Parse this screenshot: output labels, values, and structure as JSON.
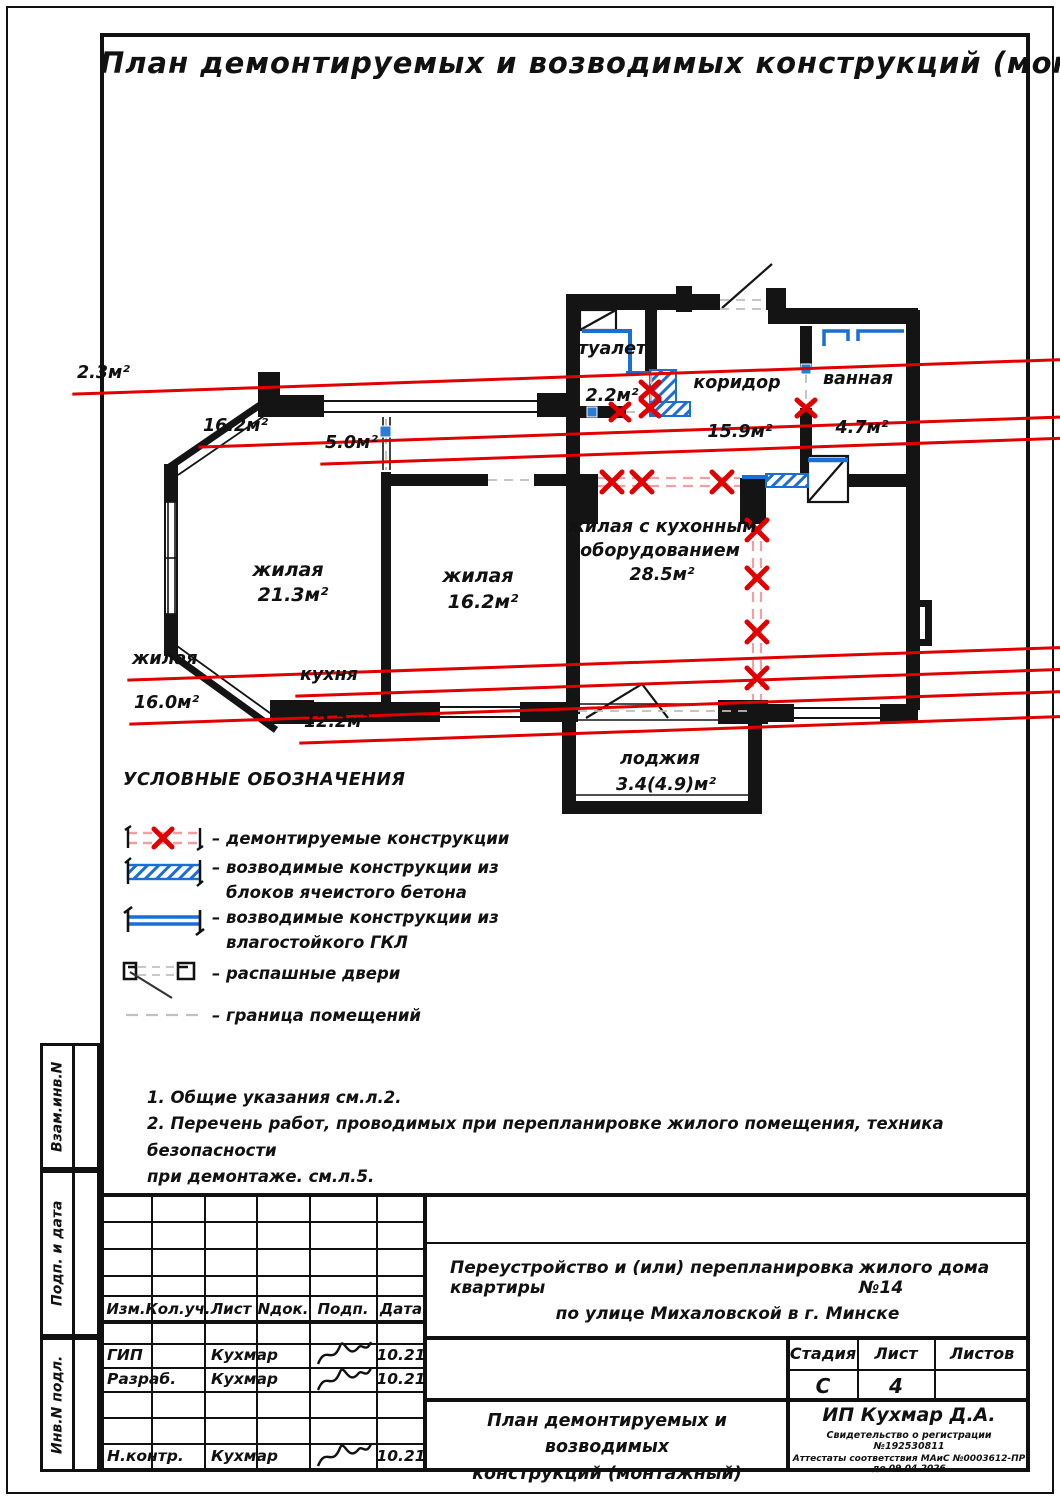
{
  "page_title": "План демонтируемых и возводимых конструкций (монтажный)",
  "plan": {
    "rooms": {
      "zhilaya1": {
        "name": "жилая",
        "area": "21.3м²"
      },
      "zhilaya2": {
        "name": "жилая",
        "area": "16.2м²"
      },
      "tualet": {
        "name": "туалет",
        "old_area": "2.3м²",
        "new_area": "2.2м²"
      },
      "koridor": {
        "name": "коридор",
        "old_area": "16.2м²",
        "new_area": "15.9м²"
      },
      "vannaya": {
        "name": "ванная",
        "old_area": "5.0м²",
        "new_area": "4.7м²"
      },
      "zhilaya_kitchen": {
        "name_line1": "жилая с кухонным",
        "name_line2": "оборудованием",
        "area": "28.5м²",
        "old_name": "жилая",
        "old_area": "16.0м²"
      },
      "kukhnya": {
        "old_name": "кухня",
        "old_area": "12.2м²"
      },
      "lodzhiya": {
        "name": "лоджия",
        "area": "3.4(4.9)м²"
      }
    }
  },
  "legend": {
    "title": "УСЛОВНЫЕ ОБОЗНАЧЕНИЯ",
    "items": [
      {
        "symbol": "demolished-structures",
        "line1": "– демонтируемые конструкции",
        "line2": ""
      },
      {
        "symbol": "aerated-concrete-block-walls",
        "line1": "– возводимые конструкции из",
        "line2": "блоков ячеистого бетона"
      },
      {
        "symbol": "moisture-resistant-gypsum-walls",
        "line1": "– возводимые конструкции из",
        "line2": "влагостойкого ГКЛ"
      },
      {
        "symbol": "swing-doors",
        "line1": "– распашные двери",
        "line2": ""
      },
      {
        "symbol": "room-boundary",
        "line1": "– граница помещений",
        "line2": ""
      }
    ]
  },
  "notes": {
    "line1": "1. Общие указания см.л.2.",
    "line2": "2. Перечень работ, проводимых при перепланировке жилого помещения, техника безопасности",
    "line3": "при демонтаже. см.л.5."
  },
  "stamp": {
    "columns": {
      "c1": "Изм.",
      "c2": "Кол.уч.",
      "c3": "Лист",
      "c4": "Nдок.",
      "c5": "Подп.",
      "c6": "Дата"
    },
    "rows": [
      {
        "role": "ГИП",
        "name": "Кухмар",
        "date": "10.21"
      },
      {
        "role": "Разраб.",
        "name": "Кухмар",
        "date": "10.21"
      },
      {
        "role": "Н.контр.",
        "name": "Кухмар",
        "date": "10.21"
      }
    ],
    "project_line1a": "Переустройство и (или) перепланировка квартиры",
    "project_line1b": "жилого дома №14",
    "project_line2": "по улице Михаловской в г. Минске",
    "stage_label": "Стадия",
    "sheet_label": "Лист",
    "sheets_label": "Листов",
    "stage_value": "С",
    "sheet_value": "4",
    "sheets_value": "",
    "drawing_title_line1": "План демонтируемых и возводимых",
    "drawing_title_line2": "конструкций (монтажный)",
    "company": "ИП Кухмар Д.А.",
    "cert_line1": "Свидетельство о регистрации №192530811",
    "cert_line2": "Аттестаты соответствия МАиС №0003612-ПР до 09.04.2026"
  },
  "sidebar": {
    "cell1": "Взам.инв.N",
    "cell2": "Подп. и дата",
    "cell3": "Инв.N подл."
  },
  "colors": {
    "demolition_red": "#e00000",
    "new_blue": "#1a6fd4",
    "wall_black": "#141414",
    "boundary_gray": "#c0c0c0"
  }
}
